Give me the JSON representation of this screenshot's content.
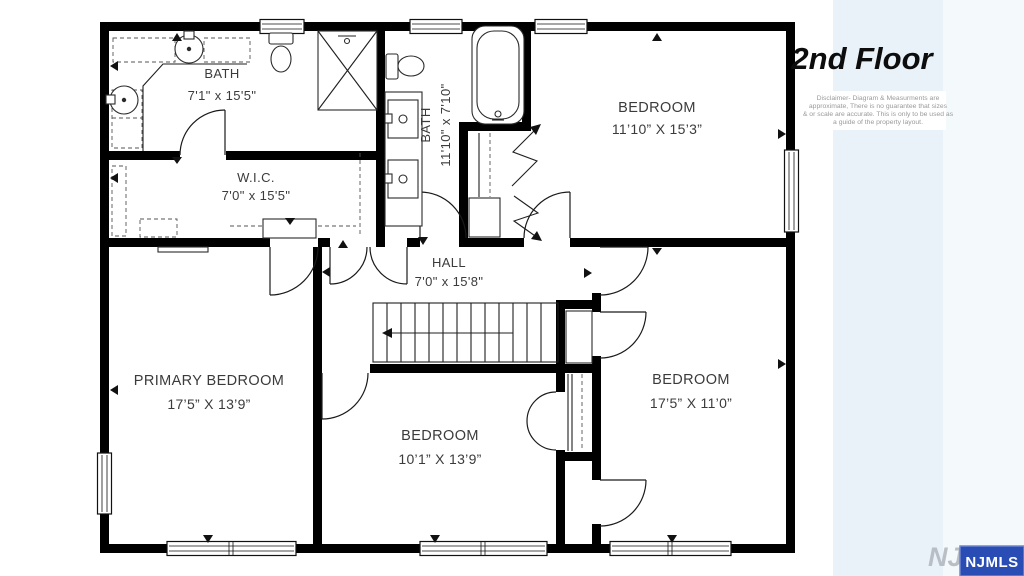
{
  "title": "2nd Floor",
  "disclaimer": {
    "lines": [
      "Disclaimer- Diagram & Measurments are",
      "approximate, There is no guarantee that sizes",
      "& or scale are accurate. This is only to be used as",
      "a guide  of the property layout."
    ]
  },
  "rooms": [
    {
      "id": "bath-top-left",
      "name": "BATH",
      "dims": "7'1\" x 15'5\""
    },
    {
      "id": "wic",
      "name": "W.I.C.",
      "dims": "7'0\" x 15'5\""
    },
    {
      "id": "bath-middle",
      "name": "BATH",
      "dims": "11'10\" x 7'10\""
    },
    {
      "id": "bedroom-top-right",
      "name": "BEDROOM",
      "dims": "11’10” X 15’3”"
    },
    {
      "id": "hall",
      "name": "HALL",
      "dims": "7'0\" x 15'8\""
    },
    {
      "id": "primary-bedroom",
      "name": "PRIMARY BEDROOM",
      "dims": "17’5” X 13’9”"
    },
    {
      "id": "bedroom-middle",
      "name": "BEDROOM",
      "dims": "10’1” X 13’9”"
    },
    {
      "id": "bedroom-bottom-right",
      "name": "BEDROOM",
      "dims": "17’5” X 11’0”"
    }
  ],
  "logo": {
    "watermark": "NJMLS",
    "badge": "NJMLS"
  },
  "colors": {
    "wall": "#000000",
    "accent_band": "#eaf2f9",
    "accent_band_light": "#f4f9fc",
    "logo_blue": "#2a4db5",
    "label_text": "#3b3b3b",
    "disclaimer_text": "#9a9a9a",
    "watermark_gray": "#b0b5bc"
  }
}
